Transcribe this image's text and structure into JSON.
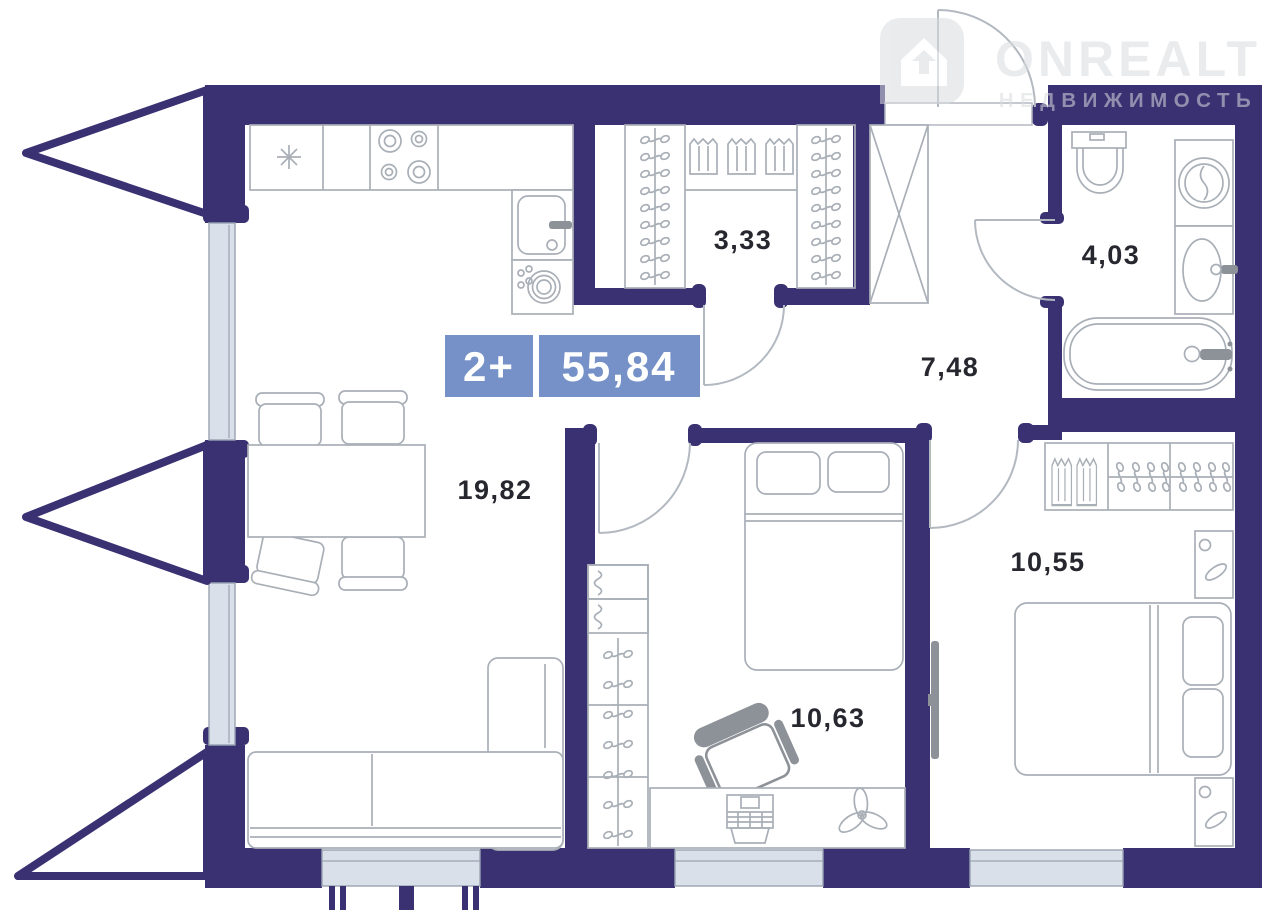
{
  "badge": {
    "rooms": "2+",
    "total_area": "55,84"
  },
  "rooms": [
    {
      "name": "kitchen-living-room",
      "area": "19,82"
    },
    {
      "name": "walk-in-closet",
      "area": "3,33"
    },
    {
      "name": "hallway",
      "area": "7,48"
    },
    {
      "name": "bathroom",
      "area": "4,03"
    },
    {
      "name": "bedroom-right",
      "area": "10,55"
    },
    {
      "name": "bedroom-middle",
      "area": "10,63"
    }
  ],
  "watermark": {
    "brand": "ONREALT",
    "tagline": "НЕДВИЖИМОСТЬ"
  },
  "colors": {
    "wall": "#3A3173",
    "win": "#D9E0E9",
    "winEdge": "#9AA4B2",
    "furn": "#A9AFB7",
    "furnDark": "#8D9298",
    "door": "#B3B9C1",
    "badge": "#7591C8",
    "label": "#27272F",
    "wm": "#D8DCDF"
  }
}
